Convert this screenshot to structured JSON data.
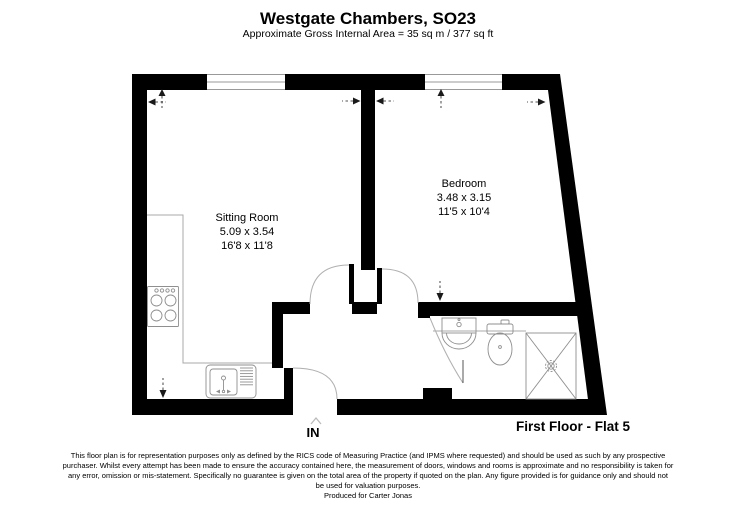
{
  "header": {
    "title": "Westgate Chambers, SO23",
    "subtitle": "Approximate Gross Internal Area = 35 sq m / 377 sq ft"
  },
  "rooms": {
    "sitting_room": {
      "name": "Sitting Room",
      "metric": "5.09 x 3.54",
      "imperial": "16'8 x 11'8"
    },
    "bedroom": {
      "name": "Bedroom",
      "metric": "3.48 x 3.15",
      "imperial": "11'5 x 10'4"
    }
  },
  "labels": {
    "entrance": "IN",
    "floor": "First Floor - Flat 5"
  },
  "footer": {
    "lines": [
      "This floor plan is for representation purposes only as defined by the RICS code of Measuring Practice (and IPMS where requested) and should be used as such by any prospective",
      "purchaser. Whilst every attempt has been made to ensure the accuracy contained here, the measurement of doors, windows and rooms is approximate and no responsibility is taken for",
      "any error, omission or mis-statement. Specifically no guarantee is given on the total area of the property if quoted on the plan. Any figure provided is for guidance only and should not",
      "be used for valuation purposes."
    ],
    "produced": "Produced for Carter Jonas"
  },
  "colors": {
    "wall": "#000000",
    "window_line": "#999999",
    "counter_line": "#a8a8a8",
    "door_arc": "#b0b0b0",
    "fixture": "#8f8f8f",
    "dimension": "#1a1a1a",
    "entry_arrow": "#bbbbbb"
  }
}
